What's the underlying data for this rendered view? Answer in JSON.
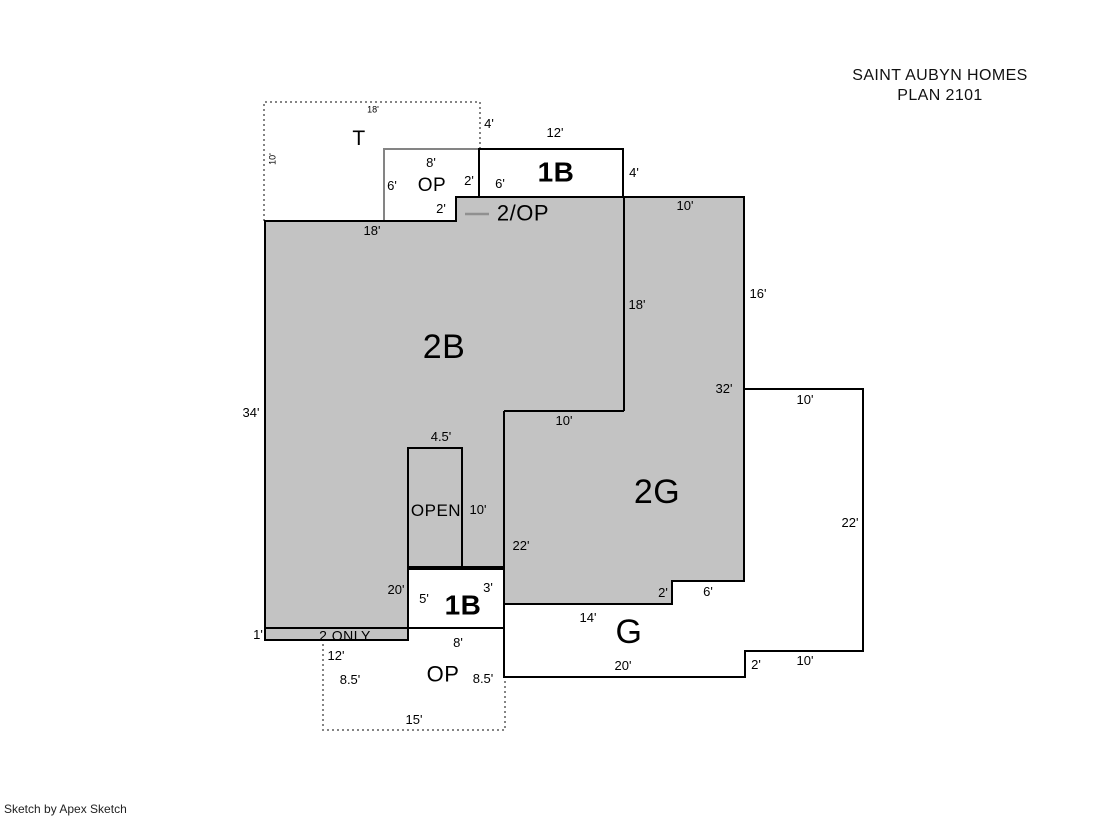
{
  "title": {
    "line1": "SAINT AUBYN HOMES",
    "line2": "PLAN 2101"
  },
  "footer": {
    "credit": "Sketch by Apex Sketch"
  },
  "colors": {
    "area_fill": "#c3c3c3",
    "outline": "#000000",
    "muted_line": "#848484"
  },
  "plan": {
    "zones": [
      {
        "id": "zone-label-t",
        "t": "T",
        "x": 359,
        "y": 139,
        "s": 21
      },
      {
        "id": "zone-label-op-top",
        "t": "OP",
        "x": 432,
        "y": 186,
        "s": 19
      },
      {
        "id": "zone-label-1b-top",
        "t": "1B",
        "x": 556,
        "y": 172,
        "s": 28,
        "b": true
      },
      {
        "id": "zone-label-2op",
        "t": "2/OP",
        "x": 523,
        "y": 213,
        "s": 22
      },
      {
        "id": "zone-label-2b",
        "t": "2B",
        "x": 444,
        "y": 348,
        "s": 34
      },
      {
        "id": "zone-label-2g",
        "t": "2G",
        "x": 657,
        "y": 493,
        "s": 34
      },
      {
        "id": "zone-label-open",
        "t": "OPEN",
        "x": 436,
        "y": 511,
        "s": 17
      },
      {
        "id": "zone-label-1b-bottom",
        "t": "1B",
        "x": 463,
        "y": 605,
        "s": 28,
        "b": true
      },
      {
        "id": "zone-label-g",
        "t": "G",
        "x": 629,
        "y": 633,
        "s": 34
      },
      {
        "id": "zone-label-op-bottom",
        "t": "OP",
        "x": 443,
        "y": 674,
        "s": 22
      },
      {
        "id": "zone-note-2-only",
        "t": "2 ONLY",
        "x": 345,
        "y": 634,
        "s": 14,
        "h": 11
      }
    ],
    "dimensions": [
      {
        "t": "18'",
        "x": 373,
        "y": 110,
        "s": 9
      },
      {
        "t": "10'",
        "x": 273,
        "y": 159,
        "s": 9,
        "rot": -90
      },
      {
        "t": "4'",
        "x": 489,
        "y": 124
      },
      {
        "t": "8'",
        "x": 431,
        "y": 163
      },
      {
        "t": "12'",
        "x": 555,
        "y": 133
      },
      {
        "t": "6'",
        "x": 392,
        "y": 186
      },
      {
        "t": "2'",
        "x": 469,
        "y": 181
      },
      {
        "t": "6'",
        "x": 500,
        "y": 184
      },
      {
        "t": "4'",
        "x": 634,
        "y": 173
      },
      {
        "t": "2'",
        "x": 441,
        "y": 209
      },
      {
        "t": "18'",
        "x": 372,
        "y": 231
      },
      {
        "t": "10'",
        "x": 685,
        "y": 206
      },
      {
        "t": "16'",
        "x": 758,
        "y": 294
      },
      {
        "t": "18'",
        "x": 637,
        "y": 305
      },
      {
        "t": "34'",
        "x": 251,
        "y": 413
      },
      {
        "t": "32'",
        "x": 724,
        "y": 389
      },
      {
        "t": "10'",
        "x": 805,
        "y": 400
      },
      {
        "t": "10'",
        "x": 564,
        "y": 421
      },
      {
        "t": "4.5'",
        "x": 441,
        "y": 437
      },
      {
        "t": "10'",
        "x": 478,
        "y": 510
      },
      {
        "t": "22'",
        "x": 850,
        "y": 523
      },
      {
        "t": "22'",
        "x": 521,
        "y": 546
      },
      {
        "t": "20'",
        "x": 396,
        "y": 590
      },
      {
        "t": "5'",
        "x": 424,
        "y": 599
      },
      {
        "t": "3'",
        "x": 488,
        "y": 588
      },
      {
        "t": "2'",
        "x": 663,
        "y": 593
      },
      {
        "t": "6'",
        "x": 708,
        "y": 592
      },
      {
        "t": "14'",
        "x": 588,
        "y": 618
      },
      {
        "t": "1'",
        "x": 258,
        "y": 635
      },
      {
        "t": "8'",
        "x": 458,
        "y": 643
      },
      {
        "t": "12'",
        "x": 336,
        "y": 656
      },
      {
        "t": "20'",
        "x": 623,
        "y": 666
      },
      {
        "t": "2'",
        "x": 756,
        "y": 665
      },
      {
        "t": "10'",
        "x": 805,
        "y": 661
      },
      {
        "t": "8.5'",
        "x": 350,
        "y": 680
      },
      {
        "t": "8.5'",
        "x": 483,
        "y": 679
      },
      {
        "t": "15'",
        "x": 414,
        "y": 720
      }
    ]
  }
}
